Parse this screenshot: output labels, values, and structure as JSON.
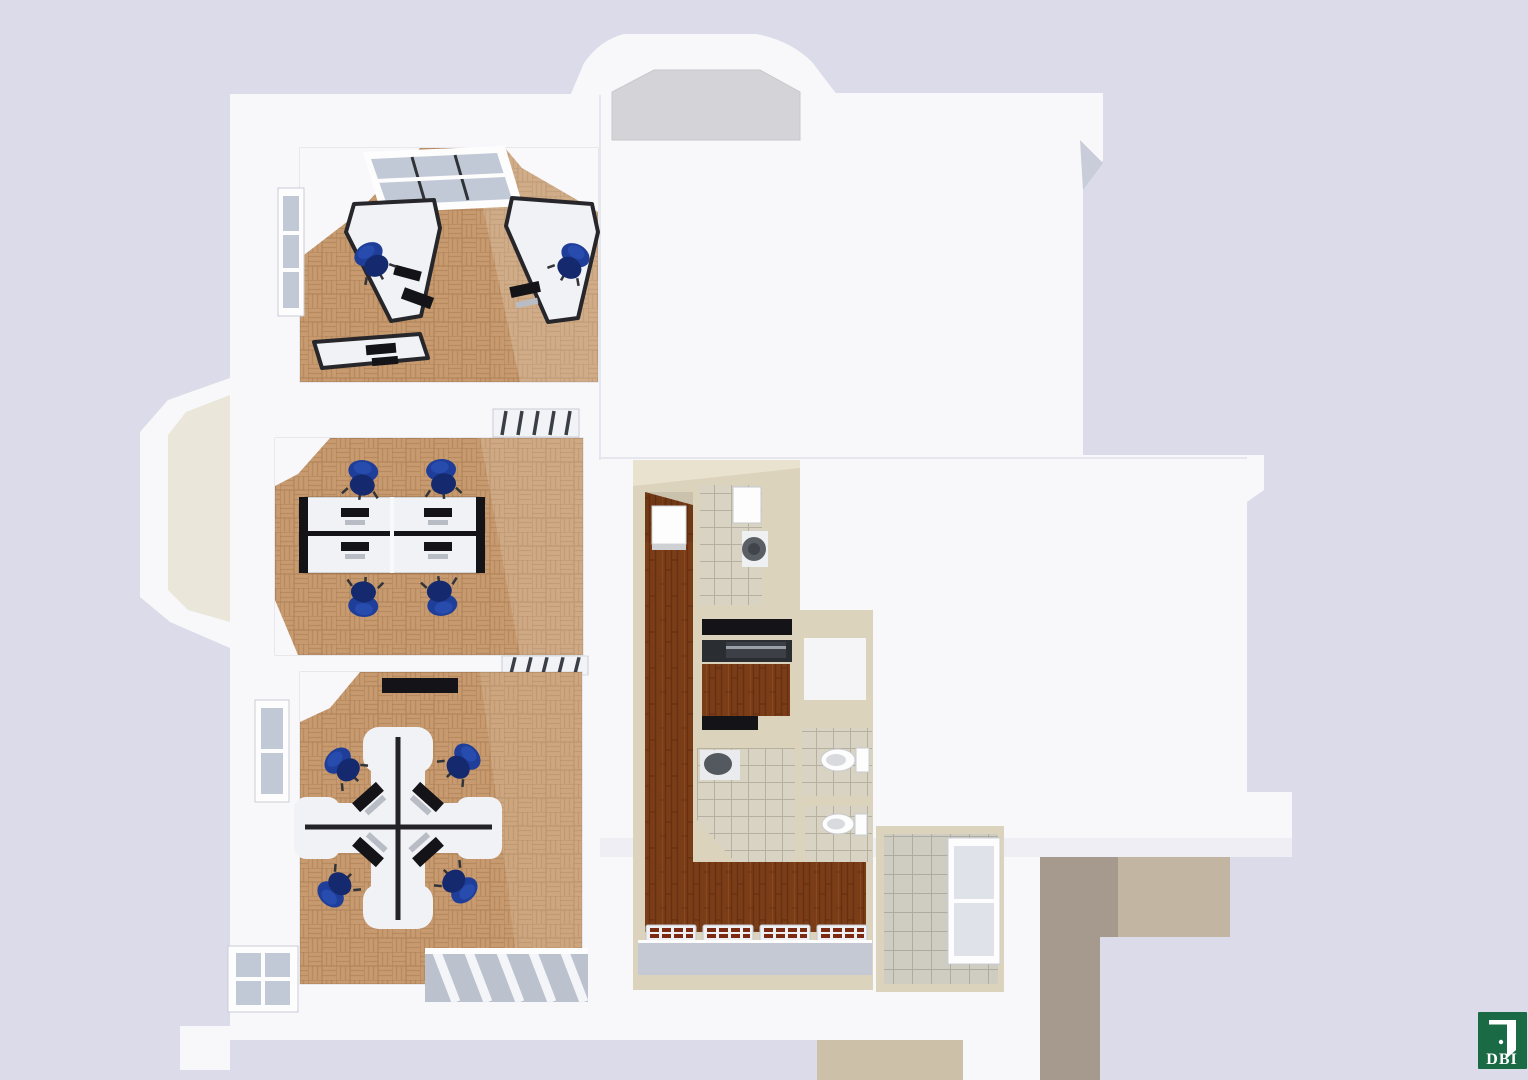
{
  "logo": {
    "text": "DBI"
  },
  "colors": {
    "background": "#dbdbe9",
    "building": "#f8f8fb",
    "buildingShade": "#eeeef4",
    "roofGray": "#d4d4d8",
    "bayCream": "#eae6d9",
    "wallCream": "#dcd3bc",
    "wallCreamLite": "#e9e2cf",
    "parquetBase": "#c79a6f",
    "parquetLine": "#a87c50",
    "woodBase": "#7b3d18",
    "woodLine": "#5c2a0d",
    "tileBase": "#d8d3c2",
    "tileLine": "#b5b0a0",
    "tileGray": "#cfccc2",
    "tileGrayLine": "#aeaba1",
    "deskWhite": "#f1f2f5",
    "deskEdge": "#26262b",
    "monitorDark": "#141418",
    "keyboardGray": "#b7bcc5",
    "chairBlue": "#1e3e99",
    "chairBlueDark": "#15296e",
    "glass": "#c2c9d6",
    "frameWhite": "#fdfdfe",
    "sillGray": "#c4c9d3",
    "skylightGray": "#bcc2cd",
    "radiatorRed": "#7c2a12",
    "tanLight": "#c2b5a1",
    "tanDark": "#a59a8d",
    "tanBlock": "#cdc0a9",
    "shaftWhite": "#f5f5f8",
    "logoGreen": "#1a6b45",
    "logoText": "#ffffff"
  },
  "scene": {
    "type": "3d-birdseye-floor-plan-render",
    "rooms": [
      {
        "id": "office-top",
        "floor": "parquet",
        "furniture": {
          "corner_desks": 2,
          "side_desks": 1,
          "chairs": 2
        },
        "windows": [
          "skylight",
          "left-wall"
        ]
      },
      {
        "id": "office-middle",
        "floor": "parquet",
        "furniture": {
          "desk_cluster": "2x2",
          "monitors": 4,
          "chairs": 4
        }
      },
      {
        "id": "office-bottom",
        "floor": "parquet",
        "furniture": {
          "desk_cluster": "cross-4",
          "monitors": 4,
          "chairs": 4,
          "wall_screen": 1
        },
        "windows": [
          "left-wall-upper",
          "left-wall-lower",
          "skylight-grid"
        ]
      },
      {
        "id": "corridor",
        "floor": "dark-wood",
        "fixtures": [
          "cabinet",
          "radiators"
        ]
      },
      {
        "id": "bathroom",
        "floor": "beige-tile",
        "fixtures": [
          "water-heater",
          "washbasin"
        ]
      },
      {
        "id": "kitchenette",
        "floor": "dark-wood",
        "fixtures": [
          "upper-shelf",
          "counter-appliance"
        ]
      },
      {
        "id": "washroom",
        "floor": "beige-tile",
        "fixtures": [
          "washbasin"
        ]
      },
      {
        "id": "wc-1",
        "floor": "beige-tile",
        "fixtures": [
          "toilet"
        ]
      },
      {
        "id": "wc-2",
        "floor": "beige-tile",
        "fixtures": [
          "toilet"
        ]
      },
      {
        "id": "utility-room",
        "floor": "gray-tile",
        "windows": [
          "right-wall"
        ]
      }
    ],
    "exterior": [
      "rounded-bay-top",
      "octagonal-bay-left",
      "gray-bay-roof",
      "tan-masonry-walls-bottom-right"
    ]
  }
}
